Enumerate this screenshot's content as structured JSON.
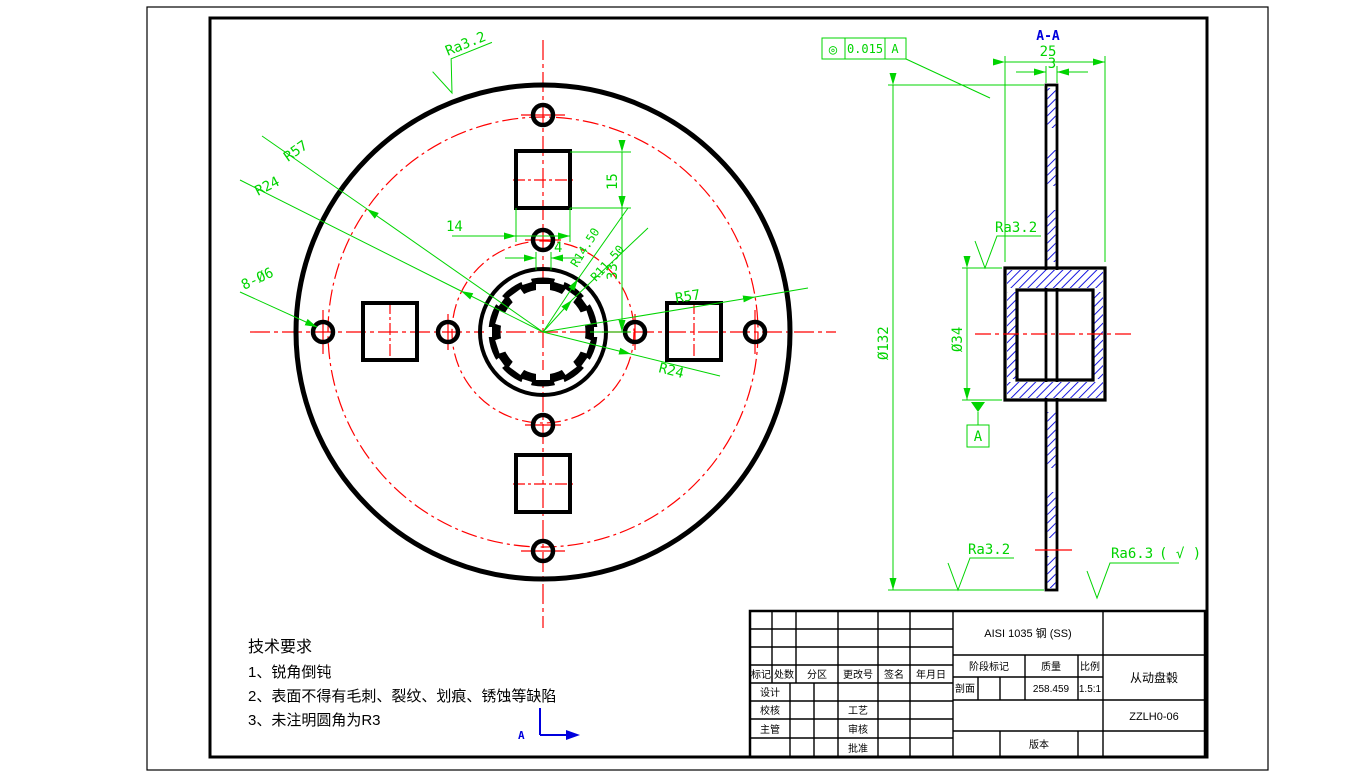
{
  "colors": {
    "dimension_green": "#00d400",
    "centerline_red": "#ff0000",
    "section_blue": "#0000dd",
    "geometry_black": "#000000"
  },
  "front_view": {
    "ra_top": "Ra3.2",
    "r57_left": "R57",
    "r24_left": "R24",
    "r57_right": "R57",
    "r24_right": "R24",
    "holes_note": "8-Ø6",
    "dim_14": "14",
    "dim_15": "15",
    "dim_33": "33",
    "dim_4": "4",
    "spline_outer_radius": "R14.50",
    "spline_inner_radius": "R11.50"
  },
  "section_view": {
    "label": "A-A",
    "dim_25": "25",
    "dim_3": "3",
    "dim_d132": "Ø132",
    "dim_d34": "Ø34",
    "ra_hub": "Ra3.2",
    "ra_web": "Ra3.2",
    "ra_general": "Ra6.3",
    "ra_general_note": "( √ )",
    "datum_label": "A",
    "gtol": {
      "symbol": "◎",
      "tolerance": "0.015",
      "datum": "A"
    }
  },
  "axes_icon": {
    "label": "A"
  },
  "tech_requirements": {
    "title": "技术要求",
    "items": [
      "1、锐角倒钝",
      "2、表面不得有毛刺、裂纹、划痕、锈蚀等缺陷",
      "3、未注明圆角为R3"
    ]
  },
  "title_block": {
    "material": "AISI 1035 钢 (SS)",
    "part_name": "从动盘毂",
    "drawing_number": "ZZLH0-06",
    "headers": {
      "mark": "标记",
      "count": "处数",
      "zone": "分区",
      "change_no": "更改号",
      "signature": "签名",
      "date": "年月日",
      "stage_mark": "阶段标记",
      "mass": "质量",
      "scale": "比例"
    },
    "values": {
      "mass": "258.459",
      "scale": "1.5:1",
      "section": "剖面"
    },
    "roles": {
      "design": "设计",
      "check": "校核",
      "supervise": "主管",
      "process": "工艺",
      "review": "审核",
      "approve": "批准"
    },
    "version_label": "版本"
  }
}
